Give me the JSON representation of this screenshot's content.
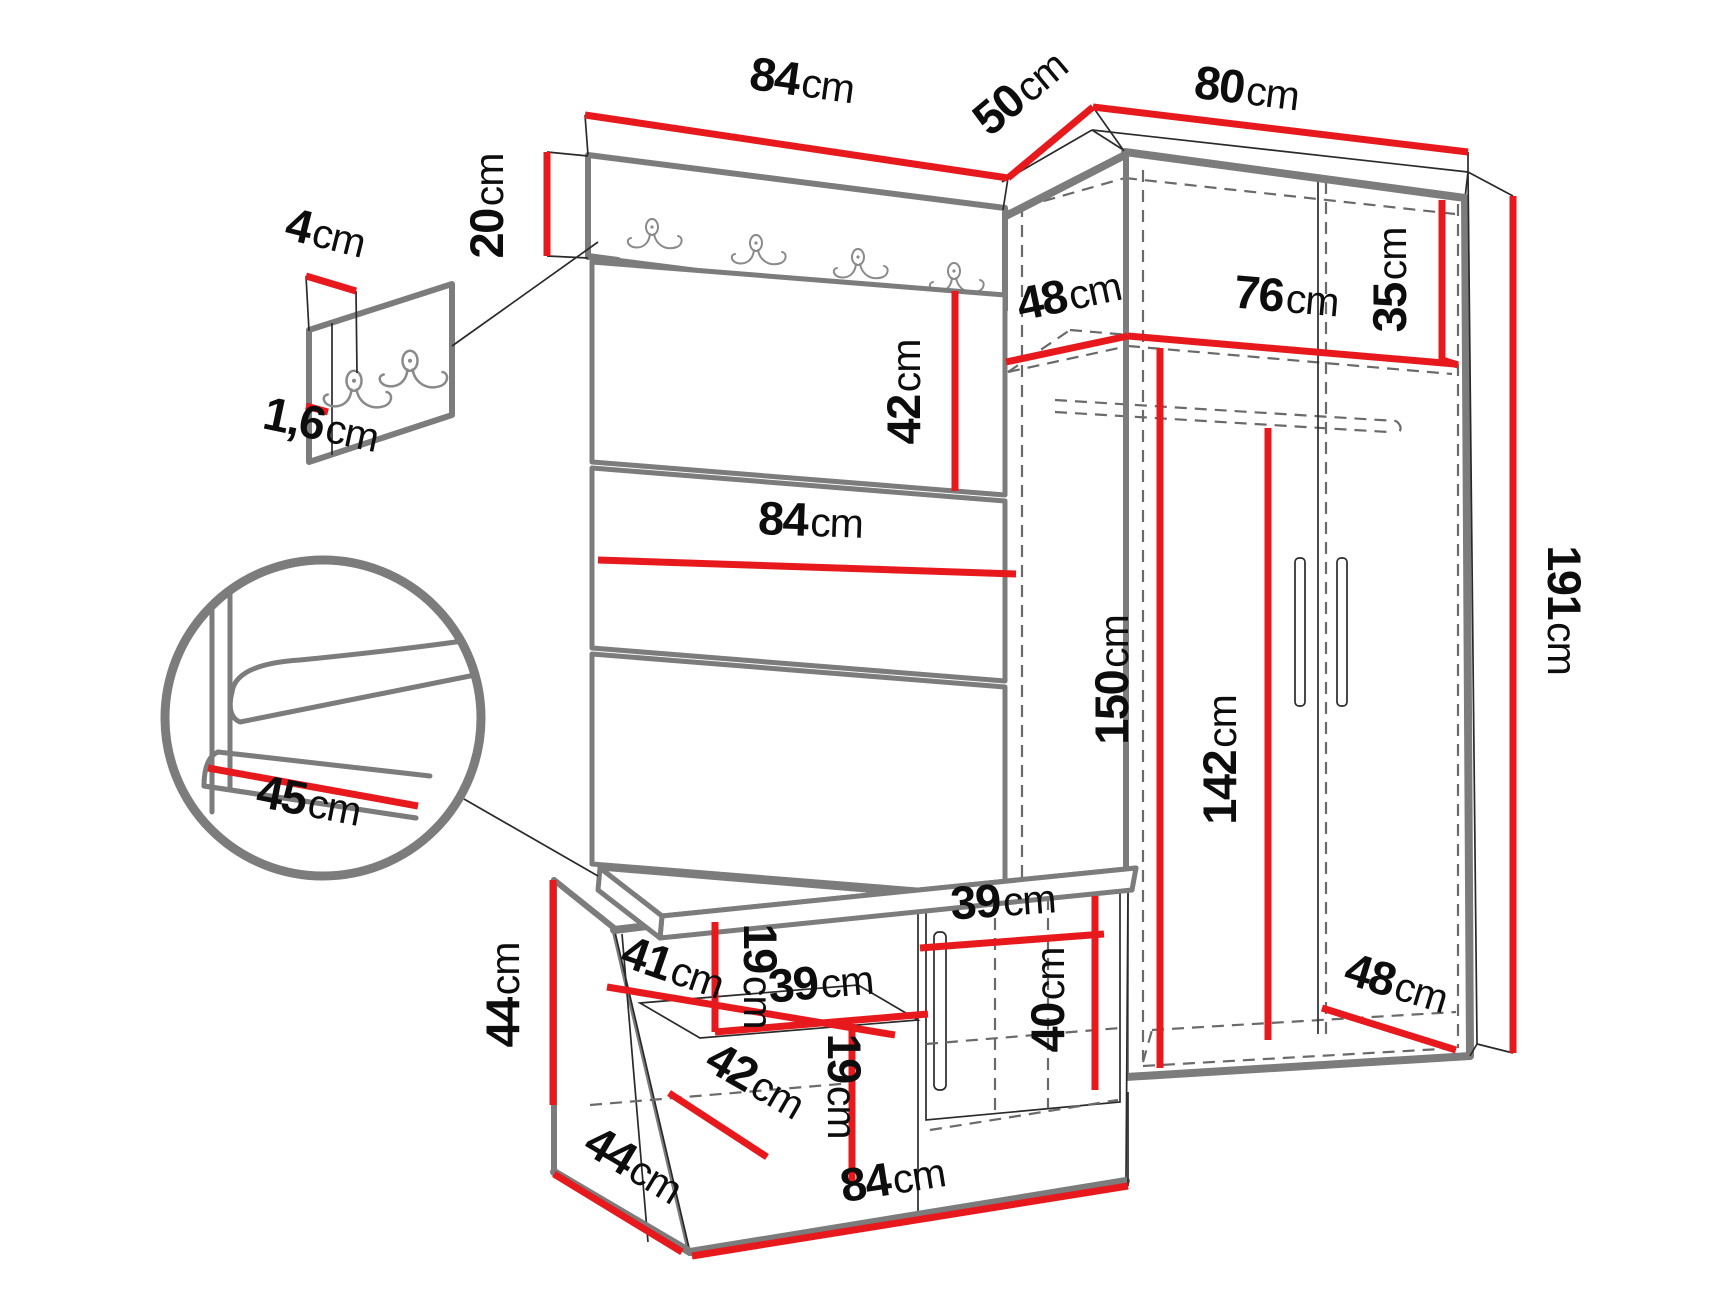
{
  "diagram": {
    "type": "furniture-dimension-diagram",
    "subject": "hallway set: coat rack panel, wardrobe and shoe bench",
    "unit": "cm"
  },
  "colors": {
    "dimension_red": "#e7191d",
    "outline_gray": "#7c7c7c",
    "label_black": "#0d0d0d",
    "background": "#ffffff"
  },
  "icons": {
    "coat_hook_count_panel": 4,
    "coat_hook_count_detail": 2
  },
  "dimensions": {
    "top_panel_width": {
      "v": "84",
      "u": "cm"
    },
    "panel_to_wardrobe_depth": {
      "v": "50",
      "u": "cm"
    },
    "wardrobe_width": {
      "v": "80",
      "u": "cm"
    },
    "hook_panel_height": {
      "v": "20",
      "u": "cm"
    },
    "hook_board_width": {
      "v": "4",
      "u": "cm"
    },
    "hook_board_thickness": {
      "v": "1,6",
      "u": "cm"
    },
    "upper_panel_height": {
      "v": "42",
      "u": "cm"
    },
    "panel_width_middle": {
      "v": "84",
      "u": "cm"
    },
    "shelf_depth": {
      "v": "48",
      "u": "cm"
    },
    "shelf_width": {
      "v": "76",
      "u": "cm"
    },
    "top_compartment_height": {
      "v": "35",
      "u": "cm"
    },
    "interior_height": {
      "v": "150",
      "u": "cm"
    },
    "door_height": {
      "v": "142",
      "u": "cm"
    },
    "wardrobe_height": {
      "v": "191",
      "u": "cm"
    },
    "seat_depth": {
      "v": "45",
      "u": "cm"
    },
    "bench_height": {
      "v": "44",
      "u": "cm"
    },
    "bench_shelf_depth": {
      "v": "41",
      "u": "cm"
    },
    "bench_upper_compartment_height": {
      "v": "19",
      "u": "cm"
    },
    "bench_shelf_width": {
      "v": "39",
      "u": "cm"
    },
    "bench_floor_depth": {
      "v": "42",
      "u": "cm"
    },
    "bench_lower_compartment_height": {
      "v": "19",
      "u": "cm"
    },
    "bench_door_width": {
      "v": "39",
      "u": "cm"
    },
    "bench_door_height": {
      "v": "40",
      "u": "cm"
    },
    "wardrobe_floor_depth": {
      "v": "48",
      "u": "cm"
    },
    "bench_depth": {
      "v": "44",
      "u": "cm"
    },
    "bench_width": {
      "v": "84",
      "u": "cm"
    }
  }
}
